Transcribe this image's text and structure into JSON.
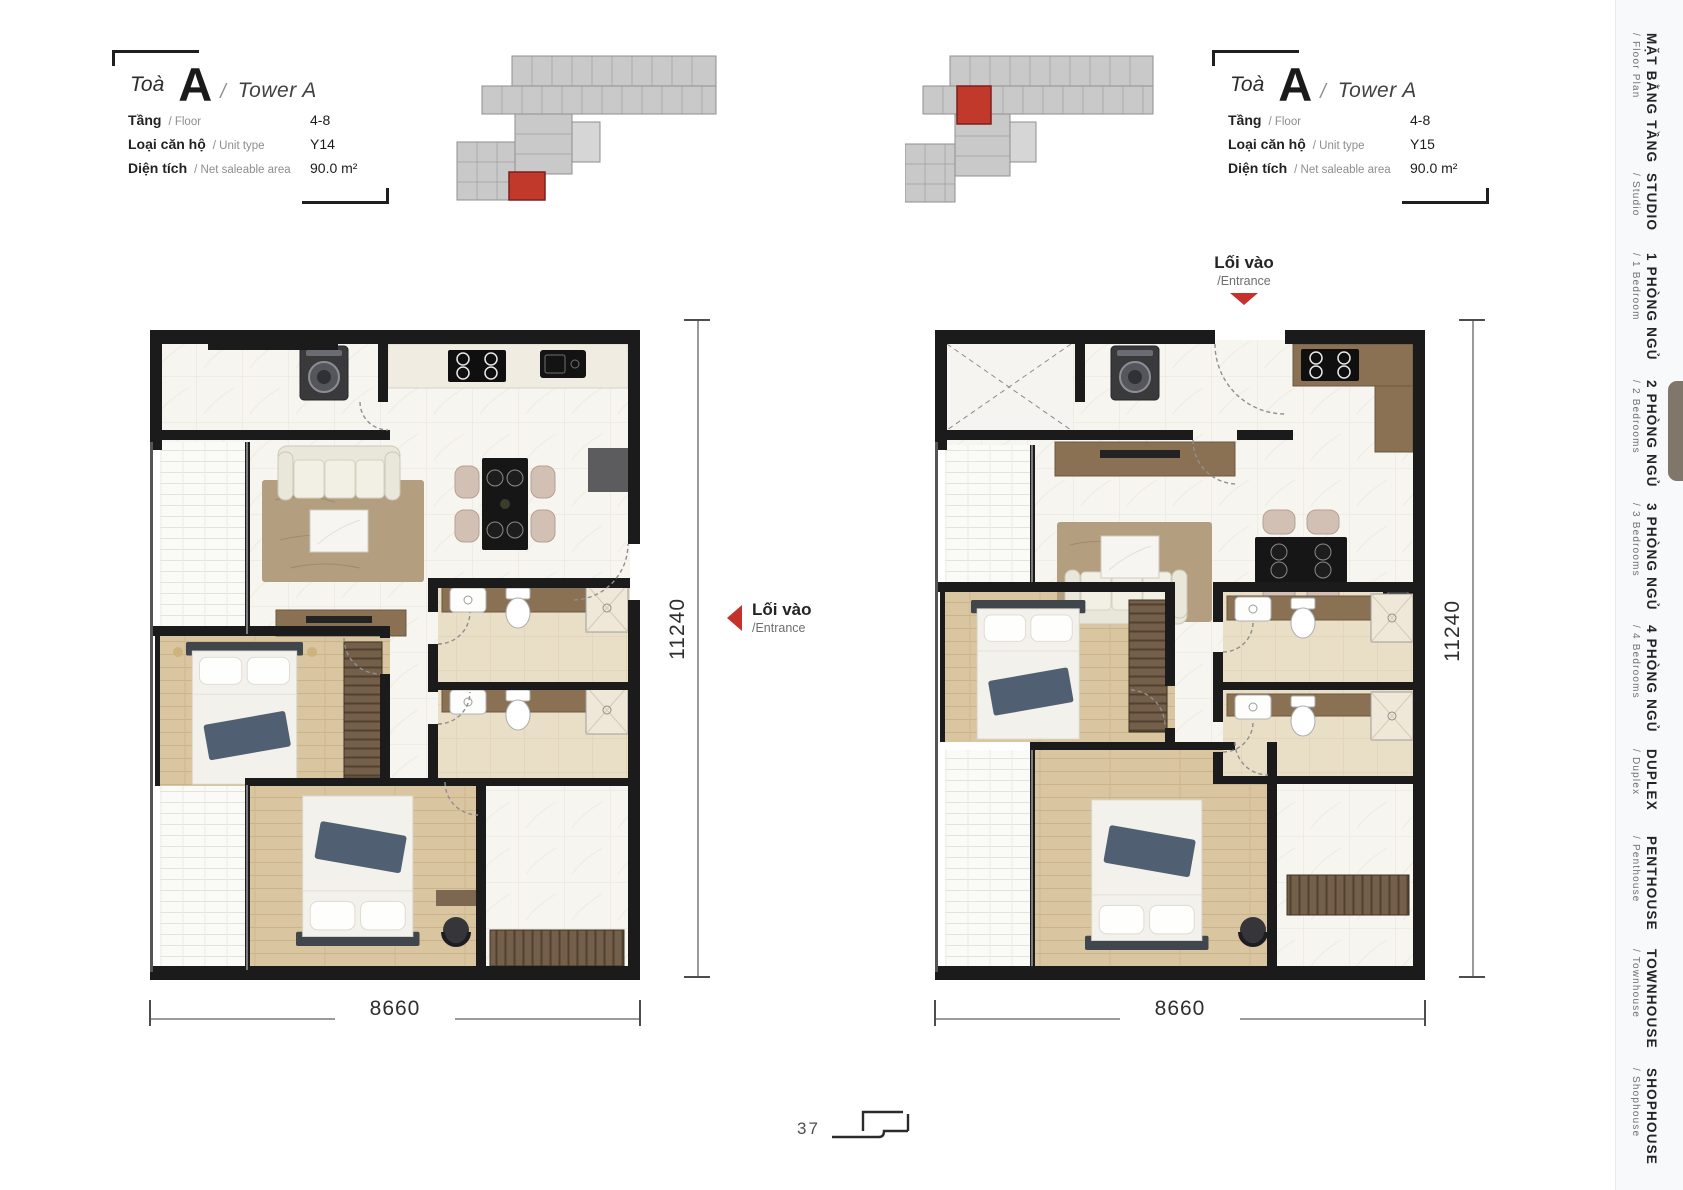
{
  "page": {
    "number": "37"
  },
  "units": [
    {
      "building_prefix": "Toà",
      "code": "A",
      "separator": "/",
      "name_en": "Tower A",
      "rows": [
        {
          "label": "Tầng",
          "sublabel": "/ Floor",
          "value": "4-8"
        },
        {
          "label": "Loại căn hộ",
          "sublabel": "/ Unit type",
          "value": "Y14"
        },
        {
          "label": "Diện tích",
          "sublabel": "/ Net saleable area",
          "value": "90.0 m²"
        }
      ],
      "entrance": {
        "label": "Lối vào",
        "sublabel": "/Entrance"
      },
      "dim_width": "8660",
      "dim_height": "11240"
    },
    {
      "building_prefix": "Toà",
      "code": "A",
      "separator": "/",
      "name_en": "Tower A",
      "rows": [
        {
          "label": "Tầng",
          "sublabel": "/ Floor",
          "value": "4-8"
        },
        {
          "label": "Loại căn hộ",
          "sublabel": "/ Unit type",
          "value": "Y15"
        },
        {
          "label": "Diện tích",
          "sublabel": "/ Net saleable area",
          "value": "90.0 m²"
        }
      ],
      "entrance": {
        "label": "Lối vào",
        "sublabel": "/Entrance"
      },
      "dim_width": "8660",
      "dim_height": "11240"
    }
  ],
  "sidebar": {
    "items": [
      {
        "label": "MẶT BẰNG TẦNG",
        "sublabel": "/ Floor Plan",
        "active": false
      },
      {
        "label": "STUDIO",
        "sublabel": "/ Studio",
        "active": false
      },
      {
        "label": "1 PHÒNG NGỦ",
        "sublabel": "/ 1 Bedroom",
        "active": false
      },
      {
        "label": "2 PHÒNG NGỦ",
        "sublabel": "/ 2 Bedrooms",
        "active": true
      },
      {
        "label": "3 PHÒNG NGỦ",
        "sublabel": "/ 3 Bedrooms",
        "active": false
      },
      {
        "label": "4 PHÒNG NGỦ",
        "sublabel": "/ 4 Bedrooms",
        "active": false
      },
      {
        "label": "DUPLEX",
        "sublabel": "/ Duplex",
        "active": false
      },
      {
        "label": "PENTHOUSE",
        "sublabel": "/ Penthouse",
        "active": false
      },
      {
        "label": "TOWNHOUSE",
        "sublabel": "/ Townhouse",
        "active": false
      },
      {
        "label": "SHOPHOUSE",
        "sublabel": "/ Shophouse",
        "active": false
      }
    ]
  },
  "colors": {
    "accent_red": "#c6322b",
    "active_marker": "#80766a",
    "wall": "#1b1b1b"
  }
}
